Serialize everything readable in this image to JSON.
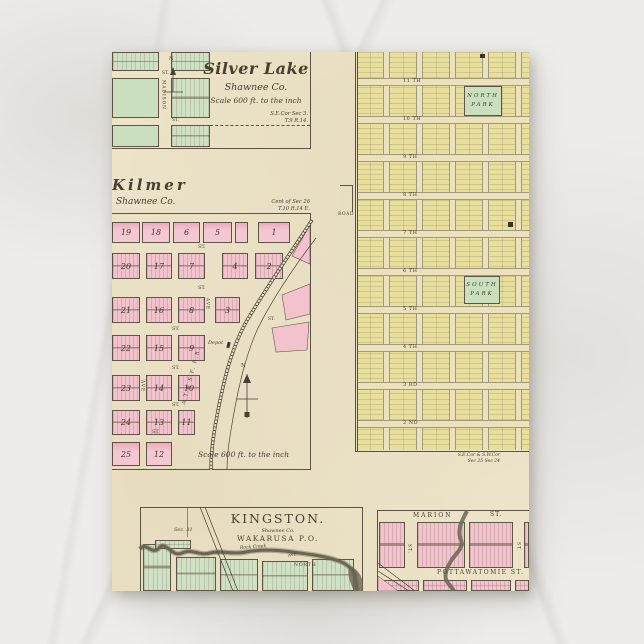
{
  "card": {
    "silver_lake": {
      "title": "Silver Lake",
      "subtitle": "Shawnee Co.",
      "scale": "Scale 600 ft. to the inch",
      "corner1": "S.E.Cor Sec 3.",
      "corner2": "T.9 R.14.",
      "st_top": "ST.",
      "st_bottom": "ST.",
      "madison": "MADISON",
      "north": "N"
    },
    "kilmer": {
      "title": "Kilmer",
      "subtitle": "Shawnee Co.",
      "corner1": "Cent of Sec 26",
      "corner2": "T.10 R.14 E.",
      "scale": "Scale 600 ft. to the inch",
      "railroad": "A.T.& S.F. R.R.",
      "depot": "Depot",
      "north": "N",
      "rows": [
        [
          "19",
          "18",
          "6",
          "5",
          "1"
        ],
        [
          "20",
          "17",
          "7",
          "4",
          "2"
        ],
        [
          "21",
          "16",
          "8",
          "3"
        ],
        [
          "22",
          "15",
          "9"
        ],
        [
          "23",
          "14",
          "10"
        ],
        [
          "24",
          "13",
          "11"
        ],
        [
          "25",
          "12"
        ]
      ],
      "st": [
        "ST.",
        "ST.",
        "ST.",
        "ST.",
        "ST.",
        "ST.",
        "ST."
      ],
      "ave": [
        "AVE",
        "AVE"
      ]
    },
    "grid_city": {
      "streets": [
        "11 TH",
        "10 TH",
        "9 TH",
        "8 TH",
        "7 TH",
        "6 TH",
        "5 TH",
        "4 TH",
        "3 RD",
        "2 ND"
      ],
      "north_park1": "NORTH",
      "north_park2": "PARK",
      "south_park1": "SOUTH",
      "south_park2": "PARK",
      "road": "ROAD",
      "corner1": "S.E.Cor & S.W.Cor",
      "corner2": "Sec 25  Sec 24"
    },
    "kingston": {
      "title": "KINGSTON.",
      "subtitle": "Shawnee Co.",
      "po": "WAKARUSA P.O.",
      "sec": "Sec. 31",
      "creek": "Rock Creek",
      "north": "NORTH",
      "ave": "AVE"
    },
    "marion": {
      "street_left": "MARION",
      "street_right": "ST.",
      "street_mid": "POTTAWATOMIE  ST.",
      "st_vert_left": "ST.",
      "st_vert_right": "ST."
    },
    "colors": {
      "card": "#ece3c8",
      "pink": "#f2c3cd",
      "yellow": "#e8df9d",
      "green": "#cfe0c3",
      "ink": "#46402f",
      "creek": "#6b6552"
    }
  }
}
